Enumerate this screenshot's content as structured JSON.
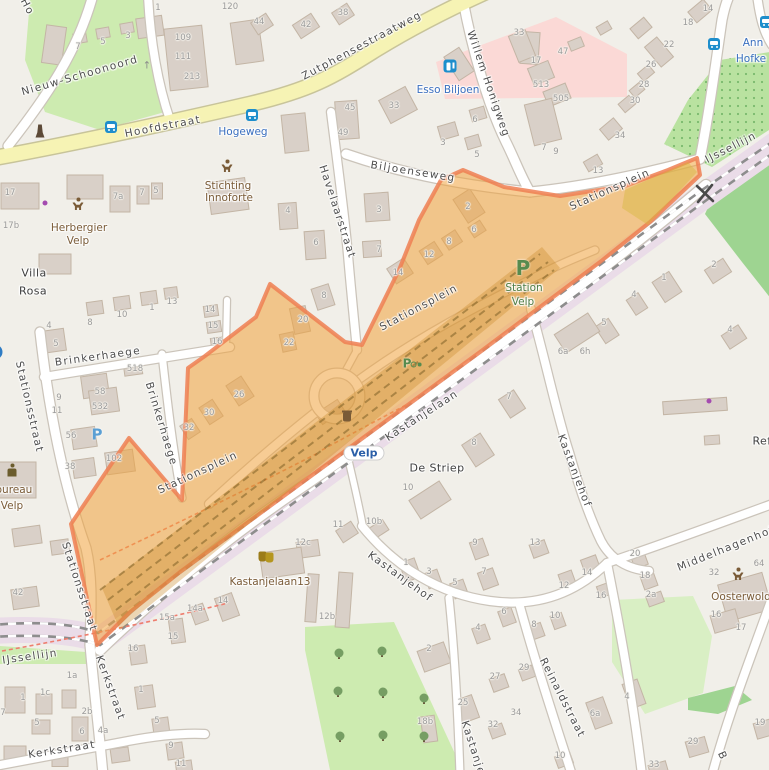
{
  "map": {
    "description": "OpenStreetMap view of the Stationsplein / station area in Velp with an orange highlighted region",
    "colors": {
      "bg": "#f1efe9",
      "grass": "#cdebb0",
      "orch": "#b9e2a0",
      "wood": "#9ed491",
      "park": "#d9efc4",
      "pink": "#fbd9d6",
      "railband": "#eadce8",
      "bld": "#d9d0c8",
      "bldline": "#c3b5a5",
      "roadcase": "#cbc4ba",
      "road": "#ffffff",
      "yellow": "#f6f3b4",
      "yellowcase": "#c8c49a",
      "hl": "#f0a33c",
      "hlb": "#ee7f52",
      "label_street": "#4d4d4d",
      "label_transit": "#3a6fbf",
      "label_poi": "#7a5b37",
      "label_housenumber": "#9b9b9b",
      "parking_green": "#578b4e",
      "parking_blue": "#5a9fd4",
      "station_blue": "#2b5fa8"
    },
    "labels": [
      {
        "t": "Ho",
        "x": 27,
        "y": 7,
        "r": 62,
        "c": "st"
      },
      {
        "t": "Nieuw-Schoonoord",
        "x": 80,
        "y": 76,
        "r": -16,
        "c": "st"
      },
      {
        "t": "Hoofdstraat",
        "x": 163,
        "y": 127,
        "r": -11,
        "c": "st"
      },
      {
        "t": "Zutphensestraatweg",
        "x": 362,
        "y": 46,
        "r": -28,
        "c": "st"
      },
      {
        "t": "Hogeweg",
        "x": 243,
        "y": 132,
        "r": 0,
        "c": "tr"
      },
      {
        "t": "Willem Honigweg",
        "x": 488,
        "y": 84,
        "r": 71,
        "c": "st"
      },
      {
        "t": "Biljoenseweg",
        "x": 413,
        "y": 172,
        "r": 9,
        "c": "st"
      },
      {
        "t": "Havelaarstraat",
        "x": 337,
        "y": 212,
        "r": 72,
        "c": "st"
      },
      {
        "t": "Stationsplein",
        "x": 610,
        "y": 190,
        "r": -24,
        "c": "st"
      },
      {
        "t": "Stationsplein",
        "x": 419,
        "y": 308,
        "r": -28,
        "c": "st"
      },
      {
        "t": "Stationsplein",
        "x": 198,
        "y": 473,
        "r": -25,
        "c": "st"
      },
      {
        "t": "Brinkerhaege",
        "x": 98,
        "y": 357,
        "r": -8,
        "c": "st"
      },
      {
        "t": "Brinkerhaege",
        "x": 161,
        "y": 424,
        "r": 73,
        "c": "st"
      },
      {
        "t": "Stationsstraat",
        "x": 29,
        "y": 407,
        "r": 77,
        "c": "st"
      },
      {
        "t": "Stationsstraat",
        "x": 79,
        "y": 587,
        "r": 72,
        "c": "st"
      },
      {
        "t": "IJssellijn",
        "x": 30,
        "y": 657,
        "r": -8,
        "c": "st"
      },
      {
        "t": "IJssellijn",
        "x": 731,
        "y": 148,
        "r": -27,
        "c": "st"
      },
      {
        "t": "Kastanjelaan",
        "x": 422,
        "y": 416,
        "r": -33,
        "c": "st"
      },
      {
        "t": "Kastanjehof",
        "x": 400,
        "y": 577,
        "r": 36,
        "c": "st"
      },
      {
        "t": "Kastanjehof",
        "x": 574,
        "y": 471,
        "r": 69,
        "c": "st"
      },
      {
        "t": "Kastanjehof",
        "x": 476,
        "y": 758,
        "r": 72,
        "c": "st"
      },
      {
        "t": "Kerkstraat",
        "x": 110,
        "y": 688,
        "r": 70,
        "c": "st"
      },
      {
        "t": "Kerkstraat",
        "x": 62,
        "y": 750,
        "r": -9,
        "c": "st"
      },
      {
        "t": "Reinaldstraat",
        "x": 562,
        "y": 698,
        "r": 63,
        "c": "st"
      },
      {
        "t": "Middelhagenhof",
        "x": 726,
        "y": 549,
        "r": -22,
        "c": "st"
      },
      {
        "t": "B",
        "x": 722,
        "y": 756,
        "r": 65,
        "c": "st"
      },
      {
        "t": "Villa",
        "x": 34,
        "y": 273,
        "r": 0,
        "c": "pl"
      },
      {
        "t": "Rosa",
        "x": 33,
        "y": 291,
        "r": 0,
        "c": "pl"
      },
      {
        "t": "De Striep",
        "x": 437,
        "y": 468,
        "r": 0,
        "c": "pl"
      },
      {
        "t": "Ref",
        "x": 762,
        "y": 441,
        "r": 0,
        "c": "pl"
      },
      {
        "t": "Esso Biljoen",
        "x": 448,
        "y": 90,
        "r": 0,
        "c": "tr"
      },
      {
        "t": "Ann",
        "x": 753,
        "y": 43,
        "r": 0,
        "c": "tr"
      },
      {
        "t": "Hofke",
        "x": 751,
        "y": 59,
        "r": 0,
        "c": "tr"
      },
      {
        "t": "Velp",
        "x": 364,
        "y": 453,
        "r": 0,
        "c": "station"
      },
      {
        "t": "Herbergier",
        "x": 79,
        "y": 228,
        "r": 0,
        "c": "poi"
      },
      {
        "t": "Velp",
        "x": 78,
        "y": 241,
        "r": 0,
        "c": "poi"
      },
      {
        "t": "Stichting",
        "x": 228,
        "y": 186,
        "r": 0,
        "c": "poi"
      },
      {
        "t": "Innoforte",
        "x": 229,
        "y": 198,
        "r": 0,
        "c": "poi"
      },
      {
        "t": "Kastanjelaan13",
        "x": 270,
        "y": 582,
        "r": 0,
        "c": "poi"
      },
      {
        "t": "Oosterwold",
        "x": 741,
        "y": 597,
        "r": 0,
        "c": "poi"
      },
      {
        "t": "Politiebureau",
        "x": -2,
        "y": 490,
        "r": 0,
        "c": "poi"
      },
      {
        "t": "Velp",
        "x": 12,
        "y": 506,
        "r": 0,
        "c": "poi"
      },
      {
        "t": "Station",
        "x": 524,
        "y": 288,
        "r": 0,
        "c": "grn"
      },
      {
        "t": "Velp",
        "x": 523,
        "y": 302,
        "r": 0,
        "c": "grn"
      }
    ],
    "house_numbers": [
      [
        158,
        8,
        "1"
      ],
      [
        78,
        47,
        "7"
      ],
      [
        103,
        42,
        "5"
      ],
      [
        128,
        36,
        "3"
      ],
      [
        183,
        38,
        "109"
      ],
      [
        183,
        57,
        "111"
      ],
      [
        192,
        77,
        "213"
      ],
      [
        230,
        7,
        "120"
      ],
      [
        10,
        193,
        "17"
      ],
      [
        11,
        226,
        "17b"
      ],
      [
        118,
        197,
        "7a"
      ],
      [
        142,
        193,
        "7"
      ],
      [
        156,
        191,
        "5"
      ],
      [
        259,
        22,
        "44"
      ],
      [
        306,
        25,
        "42"
      ],
      [
        343,
        13,
        "38"
      ],
      [
        350,
        108,
        "45"
      ],
      [
        343,
        133,
        "49"
      ],
      [
        394,
        106,
        "33"
      ],
      [
        443,
        143,
        "3"
      ],
      [
        477,
        155,
        "5"
      ],
      [
        475,
        120,
        "6"
      ],
      [
        519,
        33,
        "33"
      ],
      [
        563,
        52,
        "47"
      ],
      [
        536,
        61,
        "17"
      ],
      [
        541,
        85,
        "513"
      ],
      [
        561,
        99,
        "505"
      ],
      [
        544,
        148,
        "7"
      ],
      [
        556,
        152,
        "9"
      ],
      [
        669,
        45,
        "22"
      ],
      [
        651,
        65,
        "26"
      ],
      [
        644,
        85,
        "28"
      ],
      [
        635,
        101,
        "30"
      ],
      [
        620,
        136,
        "34"
      ],
      [
        598,
        171,
        "13"
      ],
      [
        688,
        23,
        "18"
      ],
      [
        708,
        9,
        "14"
      ],
      [
        288,
        211,
        "4"
      ],
      [
        316,
        243,
        "6"
      ],
      [
        324,
        296,
        "8"
      ],
      [
        379,
        210,
        "3"
      ],
      [
        379,
        250,
        "7"
      ],
      [
        468,
        207,
        "2"
      ],
      [
        474,
        230,
        "6"
      ],
      [
        449,
        242,
        "8"
      ],
      [
        429,
        255,
        "12"
      ],
      [
        398,
        273,
        "14"
      ],
      [
        303,
        320,
        "20"
      ],
      [
        289,
        343,
        "22"
      ],
      [
        56,
        344,
        "5"
      ],
      [
        49,
        326,
        "4"
      ],
      [
        90,
        323,
        "8"
      ],
      [
        122,
        315,
        "10"
      ],
      [
        152,
        308,
        "1"
      ],
      [
        172,
        302,
        "13"
      ],
      [
        210,
        310,
        "14"
      ],
      [
        213,
        326,
        "15"
      ],
      [
        217,
        342,
        "16"
      ],
      [
        135,
        369,
        "518"
      ],
      [
        100,
        392,
        "58"
      ],
      [
        100,
        407,
        "532"
      ],
      [
        59,
        398,
        "9"
      ],
      [
        57,
        411,
        "11"
      ],
      [
        71,
        436,
        "56"
      ],
      [
        70,
        467,
        "38"
      ],
      [
        114,
        459,
        "102"
      ],
      [
        239,
        395,
        "26"
      ],
      [
        209,
        413,
        "30"
      ],
      [
        189,
        428,
        "32"
      ],
      [
        714,
        265,
        "2"
      ],
      [
        664,
        278,
        "1"
      ],
      [
        634,
        295,
        "4"
      ],
      [
        604,
        323,
        "5"
      ],
      [
        730,
        330,
        "4"
      ],
      [
        563,
        352,
        "6a"
      ],
      [
        585,
        352,
        "6h"
      ],
      [
        509,
        397,
        "7"
      ],
      [
        474,
        443,
        "8"
      ],
      [
        408,
        488,
        "10"
      ],
      [
        374,
        522,
        "10b"
      ],
      [
        338,
        525,
        "11"
      ],
      [
        18,
        593,
        "42"
      ],
      [
        72,
        676,
        "1a"
      ],
      [
        45,
        693,
        "1c"
      ],
      [
        23,
        698,
        "1"
      ],
      [
        87,
        712,
        "2b"
      ],
      [
        37,
        723,
        "5"
      ],
      [
        82,
        732,
        "6"
      ],
      [
        103,
        731,
        "4a"
      ],
      [
        3,
        713,
        "7"
      ],
      [
        133,
        649,
        "16"
      ],
      [
        173,
        637,
        "15"
      ],
      [
        167,
        618,
        "15a"
      ],
      [
        195,
        609,
        "14a"
      ],
      [
        223,
        601,
        "14"
      ],
      [
        141,
        690,
        "1"
      ],
      [
        157,
        721,
        "5"
      ],
      [
        171,
        746,
        "9"
      ],
      [
        181,
        764,
        "11"
      ],
      [
        303,
        543,
        "12c"
      ],
      [
        327,
        617,
        "12b"
      ],
      [
        406,
        563,
        "1"
      ],
      [
        429,
        572,
        "3"
      ],
      [
        455,
        583,
        "5"
      ],
      [
        475,
        543,
        "9"
      ],
      [
        484,
        572,
        "7"
      ],
      [
        504,
        612,
        "6"
      ],
      [
        478,
        628,
        "4"
      ],
      [
        429,
        649,
        "2"
      ],
      [
        495,
        677,
        "27"
      ],
      [
        463,
        703,
        "25"
      ],
      [
        493,
        725,
        "32"
      ],
      [
        425,
        722,
        "18b"
      ],
      [
        535,
        543,
        "13"
      ],
      [
        635,
        554,
        "20"
      ],
      [
        645,
        576,
        "18"
      ],
      [
        651,
        595,
        "2a"
      ],
      [
        587,
        573,
        "14"
      ],
      [
        564,
        586,
        "12"
      ],
      [
        601,
        596,
        "16"
      ],
      [
        534,
        625,
        "8"
      ],
      [
        555,
        616,
        "10"
      ],
      [
        524,
        668,
        "29"
      ],
      [
        516,
        713,
        "34"
      ],
      [
        627,
        697,
        "4"
      ],
      [
        595,
        714,
        "6a"
      ],
      [
        560,
        756,
        "10"
      ],
      [
        714,
        573,
        "32"
      ],
      [
        759,
        564,
        "64"
      ],
      [
        716,
        615,
        "16"
      ],
      [
        741,
        628,
        "17"
      ],
      [
        760,
        723,
        "19"
      ],
      [
        693,
        742,
        "29"
      ],
      [
        654,
        765,
        "33"
      ]
    ],
    "icons": [
      {
        "t": "bus",
        "x": 111,
        "y": 127
      },
      {
        "t": "bus",
        "x": 252,
        "y": 115
      },
      {
        "t": "bus",
        "x": 714,
        "y": 44
      },
      {
        "t": "bus",
        "x": 766,
        "y": 22
      },
      {
        "t": "fuel",
        "x": 450,
        "y": 66
      },
      {
        "t": "parking-blue",
        "x": 97,
        "y": 434
      },
      {
        "t": "parking-circle",
        "x": -5,
        "y": 352
      },
      {
        "t": "parking-green",
        "x": 523,
        "y": 268
      },
      {
        "t": "bike-parking",
        "x": 407,
        "y": 362
      },
      {
        "t": "person",
        "x": 78,
        "y": 204
      },
      {
        "t": "person",
        "x": 227,
        "y": 166
      },
      {
        "t": "person",
        "x": 738,
        "y": 574
      },
      {
        "t": "police",
        "x": 12,
        "y": 470
      },
      {
        "t": "theater",
        "x": 266,
        "y": 557
      },
      {
        "t": "monument",
        "x": 40,
        "y": 131
      },
      {
        "t": "bin",
        "x": 347,
        "y": 417
      },
      {
        "t": "dot-purple",
        "x": 45,
        "y": 203
      },
      {
        "t": "dot-purple",
        "x": 709,
        "y": 401
      },
      {
        "t": "arrow-up",
        "x": 147,
        "y": 63
      }
    ]
  }
}
